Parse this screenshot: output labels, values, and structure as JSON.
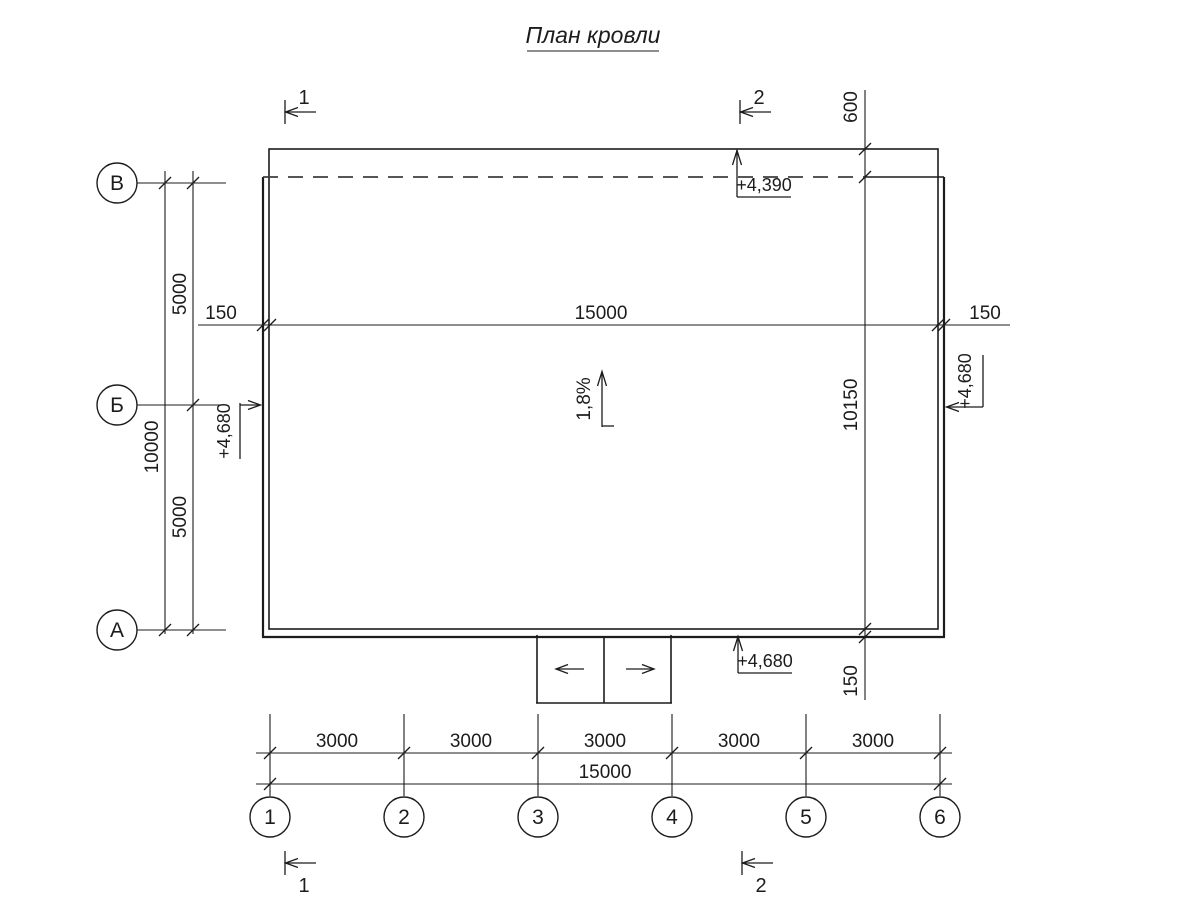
{
  "title": "План кровли",
  "colors": {
    "line": "#1c1c1c",
    "dashed_line": "#3f3f3f",
    "background": "#ffffff"
  },
  "row_axes": [
    {
      "label": "В"
    },
    {
      "label": "Б"
    },
    {
      "label": "А"
    }
  ],
  "col_axes": [
    {
      "label": "1"
    },
    {
      "label": "2"
    },
    {
      "label": "3"
    },
    {
      "label": "4"
    },
    {
      "label": "5"
    },
    {
      "label": "6"
    }
  ],
  "sections": {
    "section_1": "1",
    "section_2": "2"
  },
  "dimensions": {
    "left_span_upper": "5000",
    "left_span_total": "10000",
    "left_span_lower": "5000",
    "parapet_left": "150",
    "roof_span": "15000",
    "parapet_right": "150",
    "right_offset_top": "600",
    "right_span": "10150",
    "right_offset_bottom": "150",
    "bays": [
      "3000",
      "3000",
      "3000",
      "3000",
      "3000"
    ],
    "bottom_total": "15000"
  },
  "elevations": {
    "top": "+4,390",
    "left": "+4,680",
    "right": "+4,680",
    "bottom": "+4,680"
  },
  "slope": "1,8%"
}
